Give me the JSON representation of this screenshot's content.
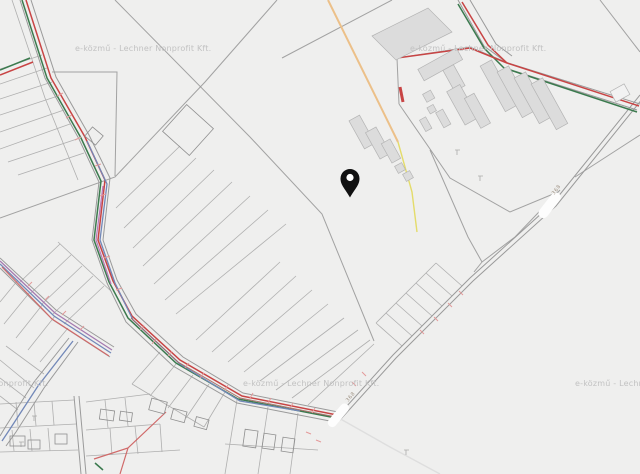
{
  "map": {
    "watermark": {
      "text": "e-közmű - Lechner Nonprofit Kft."
    },
    "road_label": {
      "text": "368"
    },
    "marker": {
      "x": 350,
      "y": 183
    }
  },
  "colors": {
    "background": "#efefee",
    "parcel-line": "#949494",
    "road-line": "#9a9a9a",
    "building-fill": "#dcdcdc",
    "building-stroke": "#b4b4b4",
    "utility-red": "#c84444",
    "utility-green": "#3b7a4e",
    "utility-blue": "#7288b8",
    "utility-magenta": "#b87ab8",
    "utility-purple": "#a57ab0",
    "utility-orange": "#ecc089",
    "utility-yellow": "#e4dc6a",
    "utility-pink": "#e49a9a",
    "utility-brown": "#a1665f",
    "watermark": "#c2c2c2",
    "pin": "#111111",
    "shield-fill": "#fdfdfd",
    "shield-text": "#a09486"
  }
}
